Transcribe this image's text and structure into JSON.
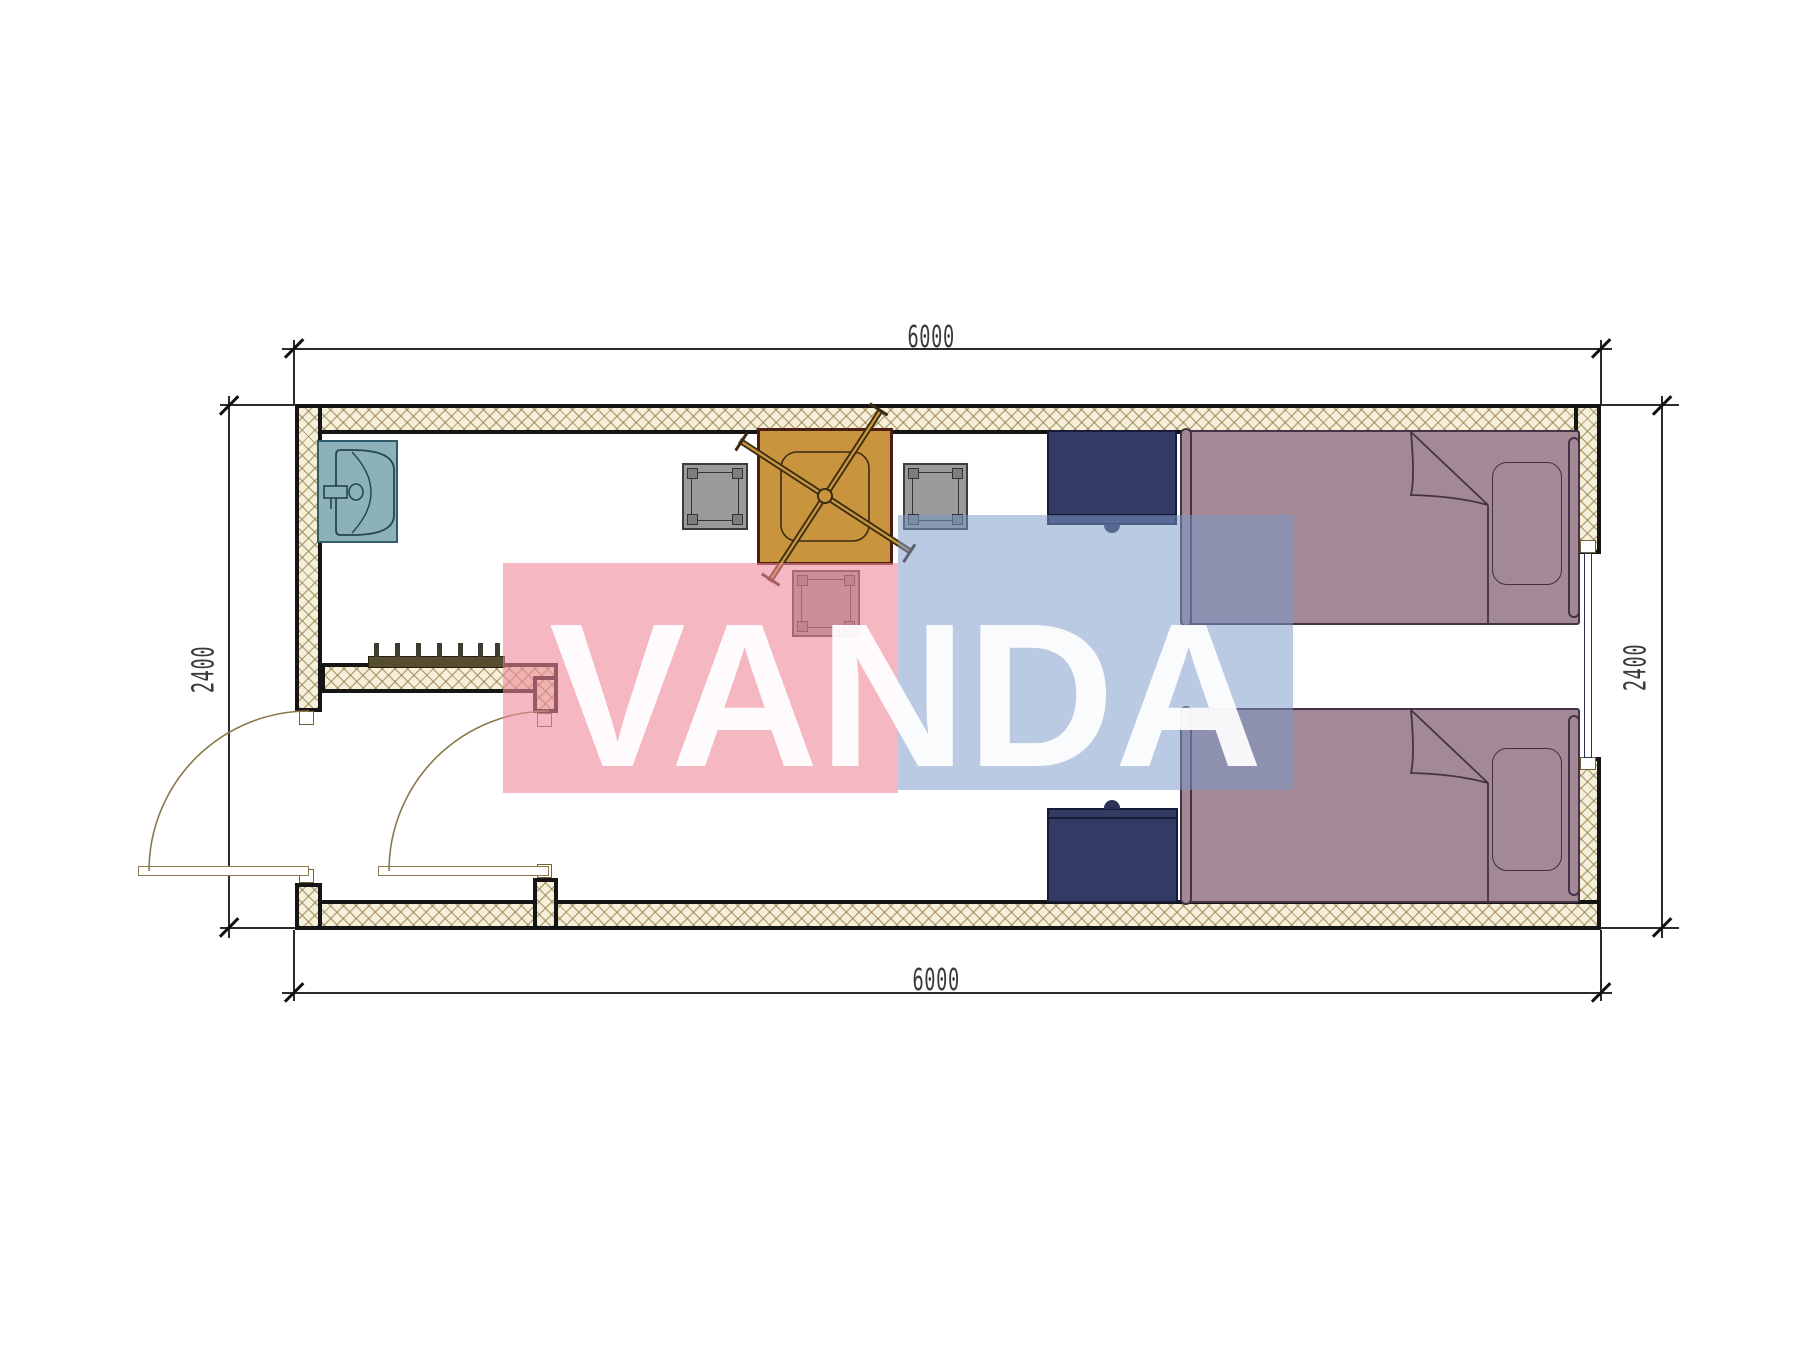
{
  "drawing": {
    "type": "architectural floor plan",
    "title": "container room 6000 x 2400 plan",
    "dimensions": {
      "top": "6000",
      "bottom": "6000",
      "left": "2400",
      "right": "2400"
    },
    "watermark": {
      "text": "VANDA",
      "pink_color": "#EE8899",
      "blue_color": "#7A99C8",
      "letter_color": "#FFFFFF"
    },
    "colors": {
      "wall_fill": "#F6F0DB",
      "wall_hatch": "#8C763E",
      "wall_line": "#151515",
      "sink": "#8DB1B8",
      "table": "#C8953E",
      "stool": "#9A9A9A",
      "nightstand": "#333A63",
      "bed": "#A28995",
      "door_arc": "#8A7A48"
    },
    "furniture": [
      {
        "name": "sink"
      },
      {
        "name": "coat-rack",
        "pegs": 7
      },
      {
        "name": "table"
      },
      {
        "name": "stool",
        "count": 3
      },
      {
        "name": "nightstand",
        "count": 2
      },
      {
        "name": "single-bed",
        "count": 2
      },
      {
        "name": "door",
        "count": 2
      },
      {
        "name": "window",
        "count": 1
      }
    ]
  }
}
